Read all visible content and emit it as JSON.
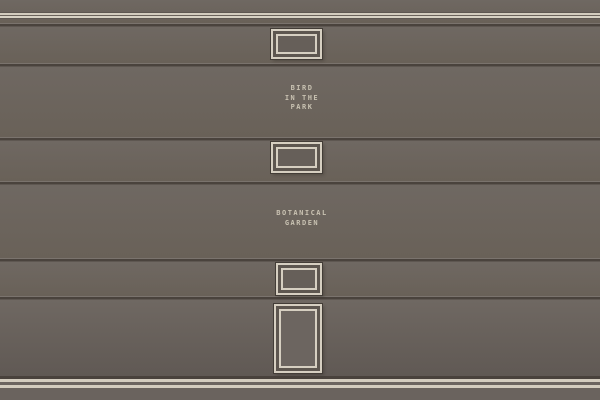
{
  "scene": {
    "type": "gallery-wall",
    "plaques": {
      "bird_in_the_park": {
        "lines": [
          "BIRD",
          "IN THE",
          "PARK"
        ]
      },
      "botanical_garden": {
        "lines": [
          "BOTANICAL",
          "GARDEN"
        ]
      }
    },
    "frames": [
      {
        "name": "small-frame-top",
        "shape": "landscape"
      },
      {
        "name": "small-frame-middle",
        "shape": "landscape"
      },
      {
        "name": "small-frame-lower",
        "shape": "landscape"
      },
      {
        "name": "tall-frame-bottom",
        "shape": "portrait"
      }
    ],
    "colors": {
      "wall": "#6c6560",
      "trim_cream": "#d6cfc1",
      "seam_dark": "#4a433d",
      "label_text": "#c9c2b2",
      "frame_interior": "#665f59",
      "baseboard_dark": "#49423c"
    }
  }
}
